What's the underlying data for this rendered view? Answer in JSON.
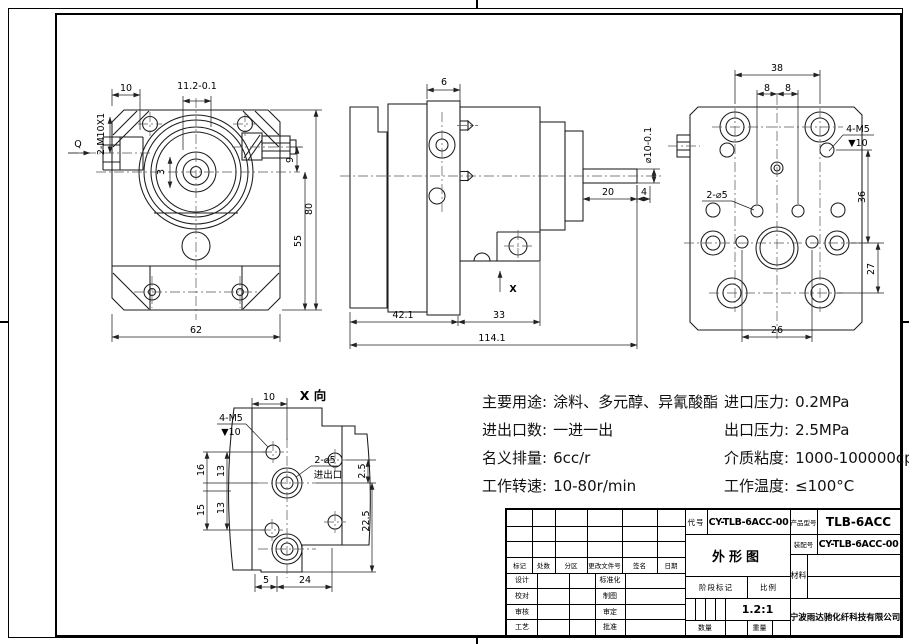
{
  "views": {
    "front": {
      "dim_10": "10",
      "dim_11_2": "11.2-0.1",
      "thread_note": "2-M10X1",
      "q_label": "Q",
      "dim_3": "3",
      "dim_9": "9",
      "dim_55": "55",
      "dim_80": "80",
      "dim_62": "62"
    },
    "side": {
      "dim_6": "6",
      "shaft_dia": "⌀10-0.1",
      "dim_20": "20",
      "dim_4": "4",
      "dim_42_1": "42.1",
      "dim_33": "33",
      "dim_114_1": "114.1",
      "view_arrow_label": "X"
    },
    "rear": {
      "dim_38": "38",
      "dim_8a": "8",
      "dim_8b": "8",
      "note_m5_l1": "4-M5",
      "note_m5_l2": "▼10",
      "note_d5": "2-⌀5",
      "dim_36": "36",
      "dim_27": "27",
      "dim_26": "26"
    },
    "xview": {
      "title": "X 向",
      "dim_10": "10",
      "note_m5_l1": "4-M5",
      "note_m5_l2": "▼10",
      "note_d5": "2-⌀5",
      "note_port": "进出口",
      "dim_16": "16",
      "dim_13a": "13",
      "dim_15": "15",
      "dim_13b": "13",
      "dim_2_5": "2.5",
      "dim_22_5": "22.5",
      "dim_5": "5",
      "dim_24": "24"
    }
  },
  "specs": {
    "left": [
      {
        "label": "主要用途:",
        "value": "涂料、多元醇、异氰酸酯"
      },
      {
        "label": "进出口数:",
        "value": "一进一出"
      },
      {
        "label": "名义排量:",
        "value": "6cc/r"
      },
      {
        "label": "工作转速:",
        "value": "10-80r/min"
      }
    ],
    "right": [
      {
        "label": "进口压力:",
        "value": "0.2MPa"
      },
      {
        "label": "出口压力:",
        "value": "2.5MPa"
      },
      {
        "label": "介质粘度:",
        "value": "1000-100000cp"
      },
      {
        "label": "工作温度:",
        "value": "≤100°C"
      }
    ]
  },
  "title_block": {
    "rev_headers": [
      "标记",
      "处数",
      "分区",
      "更改文件号",
      "签名",
      "日期"
    ],
    "sign_rows": [
      {
        "left": "设计",
        "right": "标准化"
      },
      {
        "left": "校对",
        "right": "制图"
      },
      {
        "left": "审核",
        "right": "审定"
      },
      {
        "left": "工艺",
        "right": "批准"
      }
    ],
    "code_label": "代号",
    "code_value": "CY-TLB-6ACC-00",
    "product_label": "产品型号",
    "product_value": "TLB-6ACC",
    "assembly_label": "装配号",
    "assembly_value": "CY-TLB-6ACC-00",
    "drawing_title": "外形图",
    "material_label": "材料",
    "stage_label": "阶段标记",
    "scale_label": "比例",
    "scale_value": "1.2:1",
    "qty_label": "数量",
    "weight_label": "重量",
    "company": "宁波雨达驰化纤科技有限公司"
  }
}
